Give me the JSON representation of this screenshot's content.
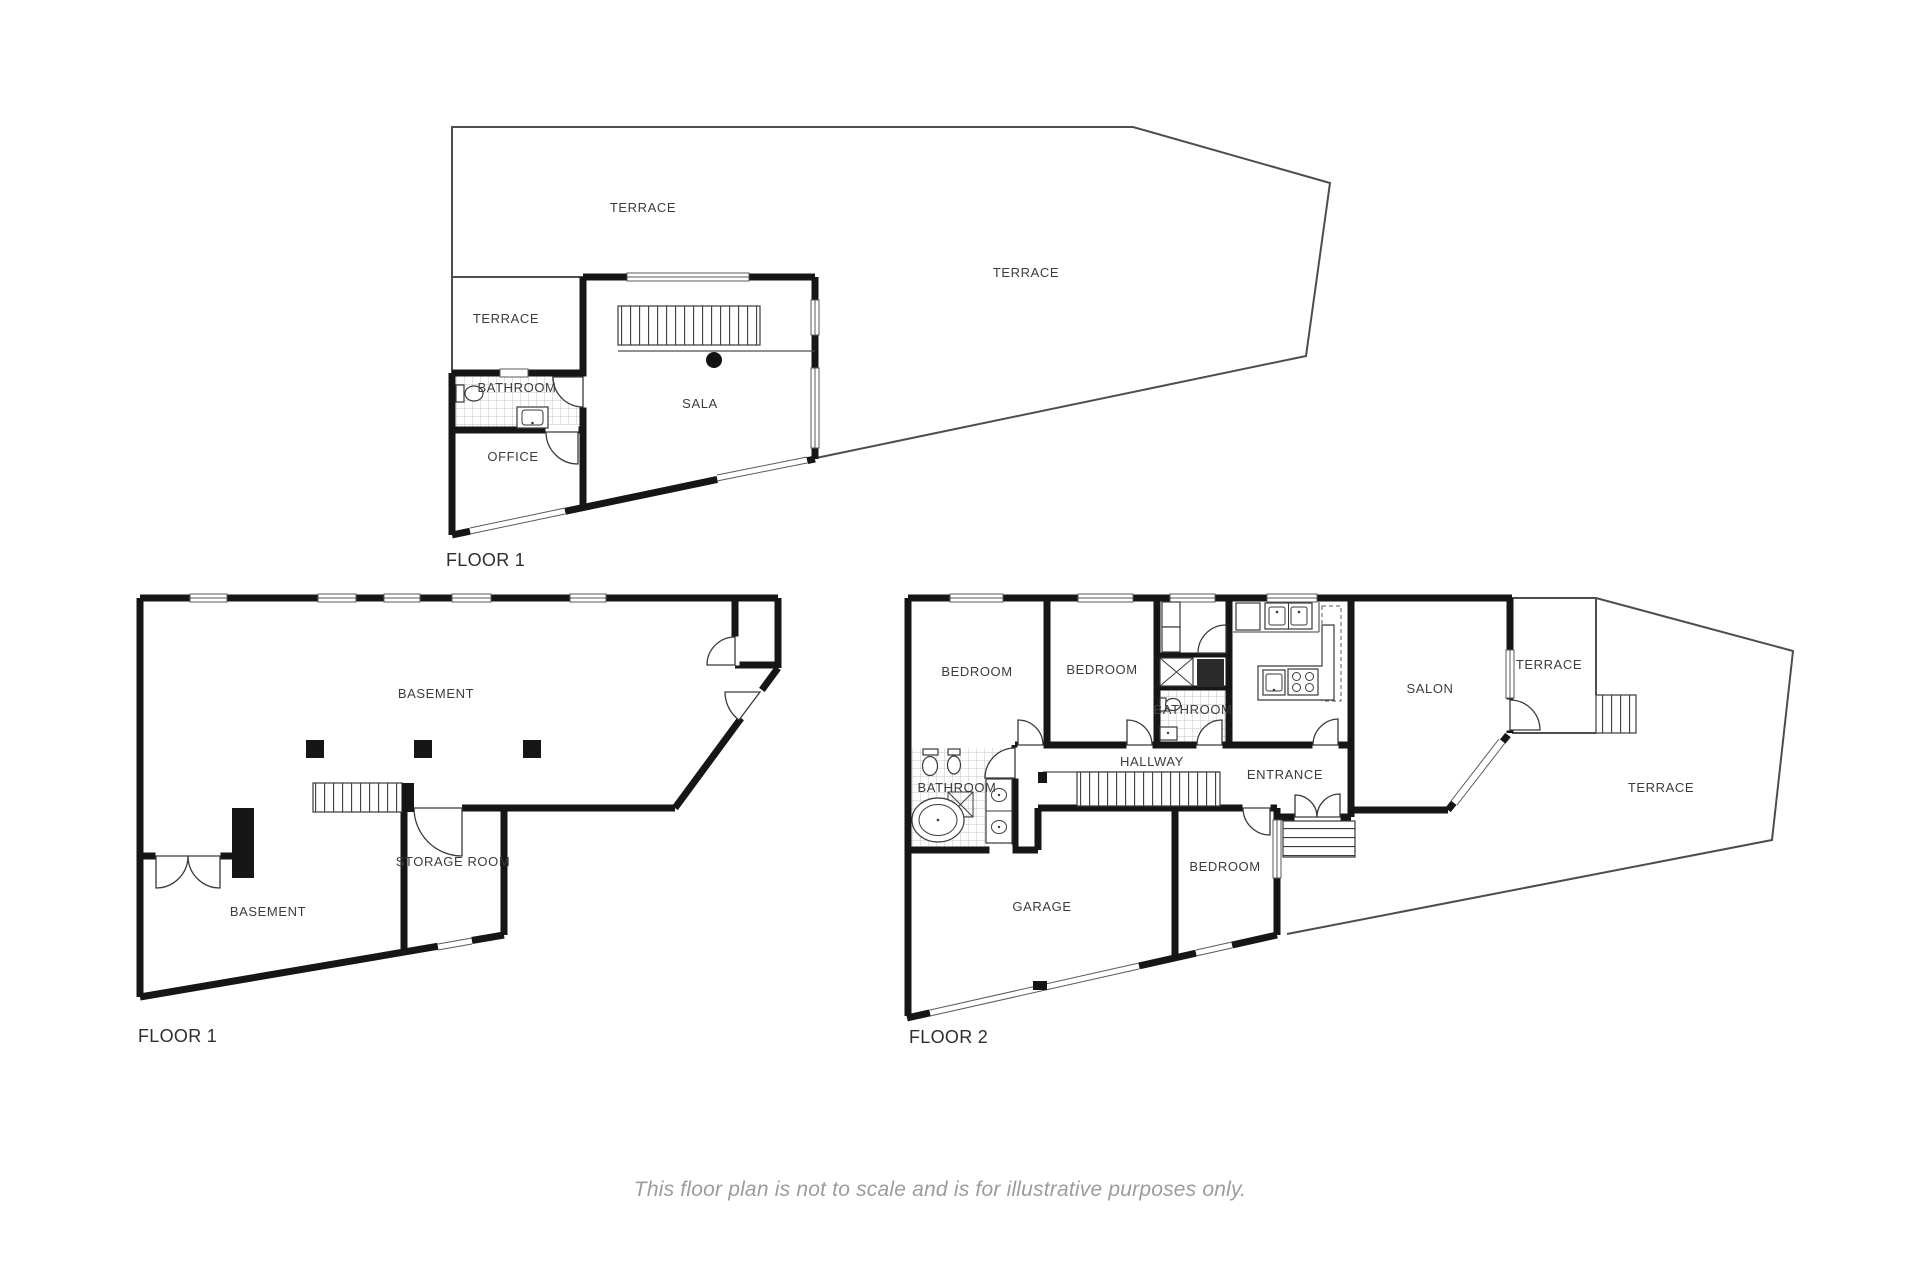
{
  "page": {
    "background": "#ffffff",
    "disclaimer": "This floor plan is not to scale and is for illustrative purposes only."
  },
  "colors": {
    "wall": "#161616",
    "thin_line": "#4d4d4d",
    "room_label": "#3c3c3c",
    "floor_label": "#2e2e2e",
    "disclaimer_text": "#9c9c9c"
  },
  "floor1_upper": {
    "floor_label": "FLOOR 1",
    "rooms": {
      "terrace_top": "TERRACE",
      "terrace_right": "TERRACE",
      "terrace_left": "TERRACE",
      "bathroom": "BATHROOM",
      "sala": "SALA",
      "office": "OFFICE"
    }
  },
  "floor1_lower": {
    "floor_label": "FLOOR 1",
    "rooms": {
      "basement_main": "BASEMENT",
      "basement_lower": "BASEMENT",
      "storage": "STORAGE ROOM"
    }
  },
  "floor2": {
    "floor_label": "FLOOR 2",
    "rooms": {
      "bedroom_left": "BEDROOM",
      "bedroom_middle": "BEDROOM",
      "bedroom_lower": "BEDROOM",
      "bathroom_hall": "BATHROOM",
      "bathroom_main": "BATHROOM",
      "hallway": "HALLWAY",
      "entrance": "ENTRANCE",
      "salon": "SALON",
      "terrace_upper": "TERRACE",
      "terrace_main": "TERRACE",
      "garage": "GARAGE"
    }
  }
}
